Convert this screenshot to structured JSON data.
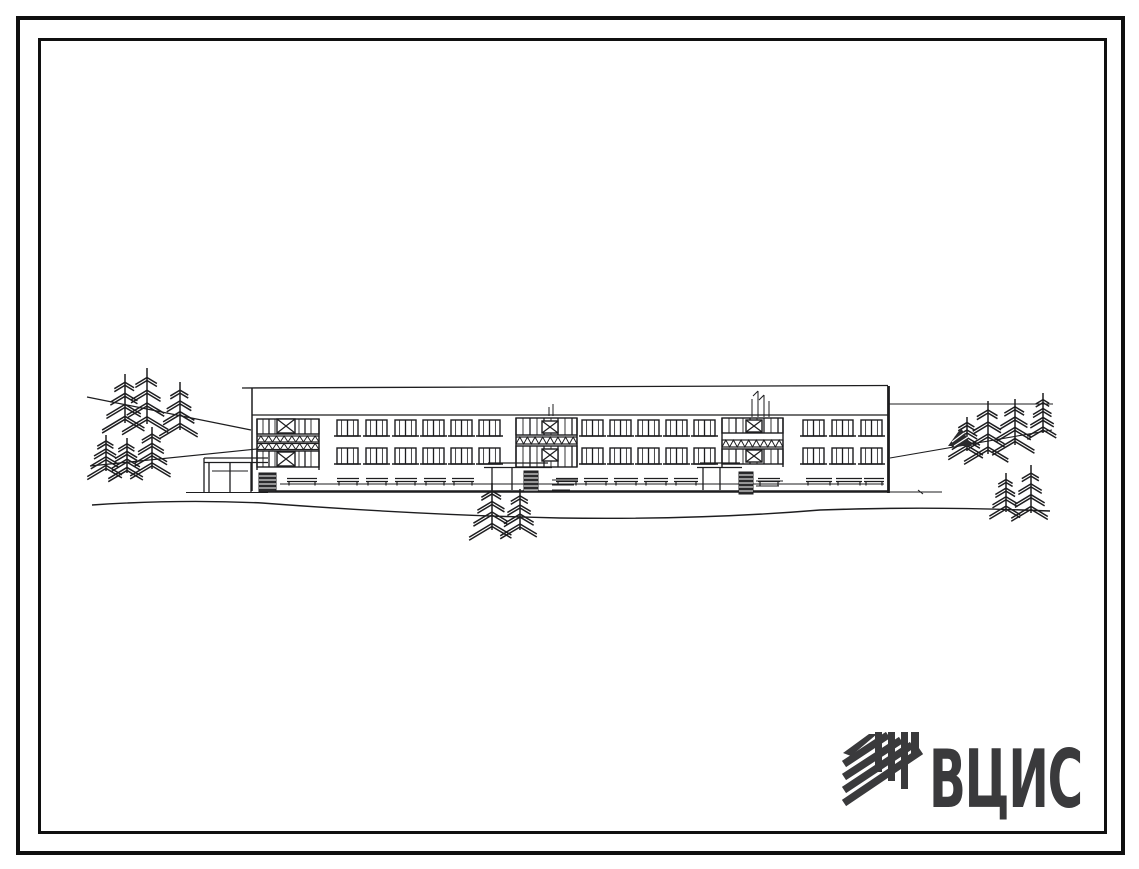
{
  "colors": {
    "paper": "#ffffff",
    "ink": "#1d1d1f",
    "frame": "#101010",
    "logo": "#3a3a3c"
  },
  "logo": {
    "text": "ВЦИС",
    "icon": "diagonal-hatch-builder-mark-icon"
  },
  "scene": {
    "type": "architectural-elevation-sketch",
    "subject": "Two-story rectangular building elevation with three glazed stair bays, entrance canopies, benches and fir trees on sloping ground",
    "building": {
      "floors": 2,
      "stair_bays": 3,
      "windows_per_row": 14,
      "window_rows": 2
    },
    "tree_clusters": 5
  }
}
